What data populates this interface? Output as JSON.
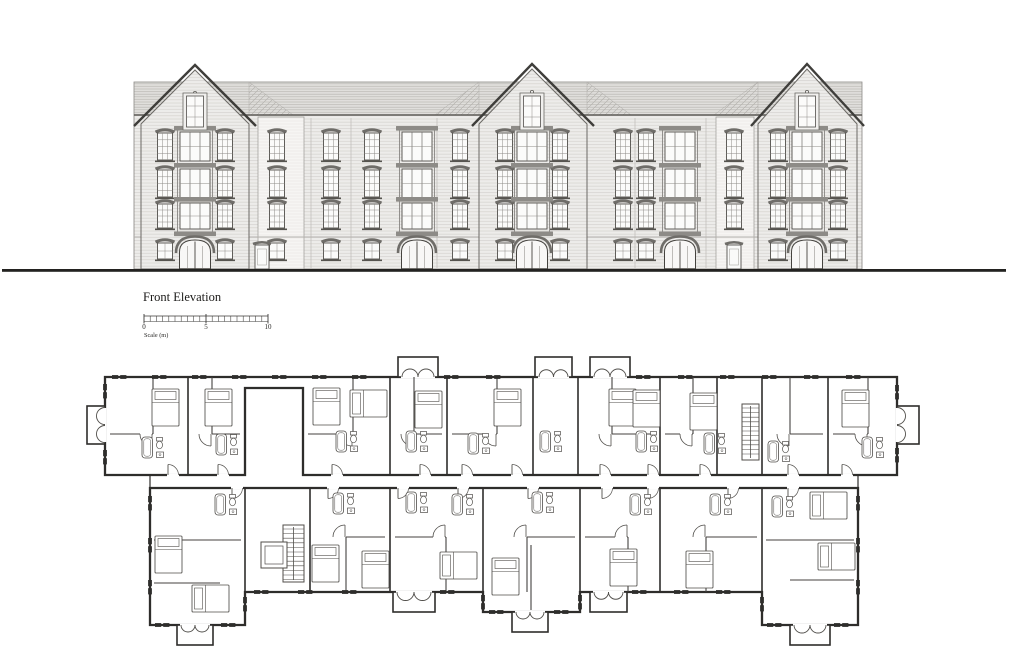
{
  "labels": {
    "title": "Front Elevation",
    "scale_label": "Scale (m)",
    "scale_ticks": [
      "0",
      "5",
      "10"
    ]
  },
  "colors": {
    "ink": "#3b3a38",
    "wall_fill": "#edecea",
    "light_fill": "#f6f5f3",
    "roof_fill": "#e0dfdc",
    "window_glass": "#fbfbfa",
    "plan_ink": "#2e2d2b",
    "furniture_ink": "#504e4a",
    "ground": "#232220"
  },
  "elevation": {
    "ground": {
      "y": 269,
      "x1": 2,
      "x2": 1006,
      "th": 2.8
    },
    "body": {
      "left": 134,
      "right": 862,
      "eaves_y": 115,
      "ridge_y": 82,
      "base_y": 269
    },
    "rows": [
      {
        "y": 133,
        "h": 27
      },
      {
        "y": 170,
        "h": 27
      },
      {
        "y": 204,
        "h": 24
      }
    ],
    "ground_row": {
      "y": 243,
      "h": 16
    },
    "gables": [
      {
        "l": 141,
        "r": 249,
        "cx": 195,
        "peak_y": 67,
        "eave_y": 124
      },
      {
        "l": 479,
        "r": 587,
        "cx": 532,
        "peak_y": 66,
        "eave_y": 124
      },
      {
        "l": 758,
        "r": 857,
        "cx": 807,
        "peak_y": 66,
        "eave_y": 124
      }
    ],
    "hips": [
      [
        249,
        1
      ],
      [
        479,
        -1
      ],
      [
        587,
        1
      ],
      [
        758,
        -1
      ]
    ],
    "light_strips": [
      {
        "x": 258,
        "w": 46
      },
      {
        "x": 716,
        "w": 38
      }
    ],
    "joints": [
      311,
      351,
      437,
      635,
      706
    ],
    "window_cols": [
      165,
      225,
      277,
      331,
      372,
      460,
      505,
      560,
      623,
      646,
      734,
      778,
      838
    ],
    "ground_windows": [
      165,
      225,
      277,
      331,
      372,
      460,
      505,
      560,
      623,
      646,
      778,
      838
    ],
    "ground_doors": [
      262,
      734
    ],
    "oriels": [
      {
        "cx": 195,
        "gable": true
      },
      {
        "cx": 417,
        "gable": false
      },
      {
        "cx": 532,
        "gable": true
      },
      {
        "cx": 680,
        "gable": false
      },
      {
        "cx": 807,
        "gable": true
      }
    ]
  },
  "scalebar": {
    "x": 144,
    "y": 316,
    "len": 124,
    "h": 5.5,
    "minor": 20,
    "title_x": 143,
    "title_y": 301,
    "label_y": 329,
    "caption_y": 337
  },
  "plan": {
    "top_band": {
      "x1": 105,
      "y1": 377,
      "x2": 897,
      "y2": 475,
      "strip_y2": 388,
      "notch": [
        245,
        303
      ]
    },
    "bump_h": 20,
    "top_bumps": [
      {
        "x": 398,
        "w": 40
      },
      {
        "x": 535,
        "w": 37
      },
      {
        "x": 590,
        "w": 40
      }
    ],
    "left_bay": {
      "x": 87,
      "y": 406,
      "w": 18,
      "h": 38
    },
    "right_bay": {
      "x": 897,
      "y": 406,
      "w": 22,
      "h": 38
    },
    "bottom_band": {
      "x1": 150,
      "y1": 488,
      "x2": 858,
      "y2": 592
    },
    "wings": [
      {
        "x1": 150,
        "x2": 245
      },
      {
        "x1": 762,
        "x2": 858
      }
    ],
    "wing_y2": 625,
    "protrusion": {
      "x1": 483,
      "x2": 580,
      "y2": 612
    },
    "bottom_bumps": [
      {
        "x": 393,
        "w": 42
      },
      {
        "x": 590,
        "w": 37
      }
    ],
    "bays_bottom": [
      {
        "x": 177,
        "y": 625,
        "w": 36
      },
      {
        "x": 512,
        "y": 612,
        "w": 36
      },
      {
        "x": 790,
        "y": 625,
        "w": 40
      }
    ],
    "bay_h": 19,
    "dividers_top": [
      188,
      390,
      447,
      533,
      578,
      660,
      717,
      762,
      828
    ],
    "dividers_bottom": [
      245,
      310,
      390,
      483,
      580,
      660,
      762
    ],
    "units_top": [
      [
        105,
        188
      ],
      [
        188,
        245
      ],
      [
        303,
        390
      ],
      [
        390,
        447
      ],
      [
        447,
        533
      ],
      [
        578,
        660
      ],
      [
        660,
        717
      ],
      [
        762,
        828
      ],
      [
        828,
        897
      ]
    ],
    "units_bottom": [
      [
        310,
        390
      ],
      [
        390,
        483
      ],
      [
        483,
        580
      ],
      [
        580,
        660
      ],
      [
        660,
        762
      ]
    ],
    "stair_top": {
      "x": 742,
      "y": 404,
      "w": 17,
      "h": 56
    },
    "stair_bottom": {
      "x": 283,
      "y": 525,
      "w": 21,
      "h": 57
    },
    "lift": {
      "x": 261,
      "y": 542,
      "w": 26,
      "h": 26
    },
    "beds_top": [
      [
        152,
        389,
        0
      ],
      [
        205,
        389,
        0
      ],
      [
        313,
        388,
        0
      ],
      [
        350,
        390,
        1
      ],
      [
        415,
        391,
        0
      ],
      [
        494,
        389,
        0
      ],
      [
        609,
        389,
        0
      ],
      [
        633,
        390,
        0
      ],
      [
        690,
        393,
        0
      ],
      [
        842,
        390,
        0
      ]
    ],
    "beds_bottom": [
      [
        155,
        536,
        0
      ],
      [
        192,
        585,
        1
      ],
      [
        312,
        545,
        0
      ],
      [
        362,
        551,
        0
      ],
      [
        440,
        552,
        1
      ],
      [
        492,
        558,
        0
      ],
      [
        610,
        549,
        0
      ],
      [
        686,
        551,
        0
      ],
      [
        810,
        492,
        1
      ],
      [
        818,
        543,
        1
      ]
    ],
    "baths_top": [
      [
        142,
        437
      ],
      [
        216,
        434
      ],
      [
        336,
        431
      ],
      [
        406,
        431
      ],
      [
        468,
        433
      ],
      [
        540,
        431
      ],
      [
        636,
        431
      ],
      [
        704,
        433
      ],
      [
        768,
        441
      ],
      [
        862,
        437
      ]
    ],
    "baths_bottom": [
      [
        215,
        494
      ],
      [
        333,
        493
      ],
      [
        406,
        492
      ],
      [
        452,
        494
      ],
      [
        532,
        492
      ],
      [
        630,
        494
      ],
      [
        710,
        494
      ],
      [
        772,
        496
      ]
    ],
    "entry_doors_top": [
      168,
      218,
      332,
      420,
      462,
      512,
      600,
      648,
      700,
      788,
      842
    ],
    "entry_doors_bottom": [
      232,
      328,
      398,
      458,
      528,
      602,
      648,
      728,
      788
    ],
    "ticks_h": [
      {
        "y": 377,
        "x1": 112,
        "x2": 392,
        "step": 40
      },
      {
        "y": 377,
        "x1": 444,
        "x2": 530,
        "step": 42
      },
      {
        "y": 377,
        "x1": 636,
        "x2": 890,
        "step": 42
      },
      {
        "y": 592,
        "x1": 254,
        "x2": 390,
        "step": 44
      },
      {
        "y": 592,
        "x1": 440,
        "x2": 478,
        "step": 36
      },
      {
        "y": 592,
        "x1": 632,
        "x2": 758,
        "step": 42
      },
      {
        "y": 625,
        "x1": 155,
        "x2": 175,
        "step": 99
      },
      {
        "y": 625,
        "x1": 221,
        "x2": 241,
        "step": 99
      },
      {
        "y": 625,
        "x1": 767,
        "x2": 787,
        "step": 99
      },
      {
        "y": 625,
        "x1": 834,
        "x2": 854,
        "step": 99
      },
      {
        "y": 612,
        "x1": 489,
        "x2": 509,
        "step": 99
      },
      {
        "y": 612,
        "x1": 554,
        "x2": 574,
        "step": 99
      }
    ],
    "ticks_v": [
      {
        "x": 105,
        "y1": 384,
        "y2": 402,
        "step": 99
      },
      {
        "x": 105,
        "y1": 450,
        "y2": 468,
        "step": 99
      },
      {
        "x": 897,
        "y1": 385,
        "y2": 403,
        "step": 99
      },
      {
        "x": 897,
        "y1": 448,
        "y2": 466,
        "step": 99
      },
      {
        "x": 150,
        "y1": 496,
        "y2": 614,
        "step": 42
      },
      {
        "x": 858,
        "y1": 496,
        "y2": 614,
        "step": 42
      },
      {
        "x": 483,
        "y1": 595,
        "y2": 609,
        "step": 99
      },
      {
        "x": 580,
        "y1": 595,
        "y2": 609,
        "step": 99
      },
      {
        "x": 245,
        "y1": 597,
        "y2": 618,
        "step": 99
      },
      {
        "x": 762,
        "y1": 597,
        "y2": 618,
        "step": 99
      }
    ]
  }
}
